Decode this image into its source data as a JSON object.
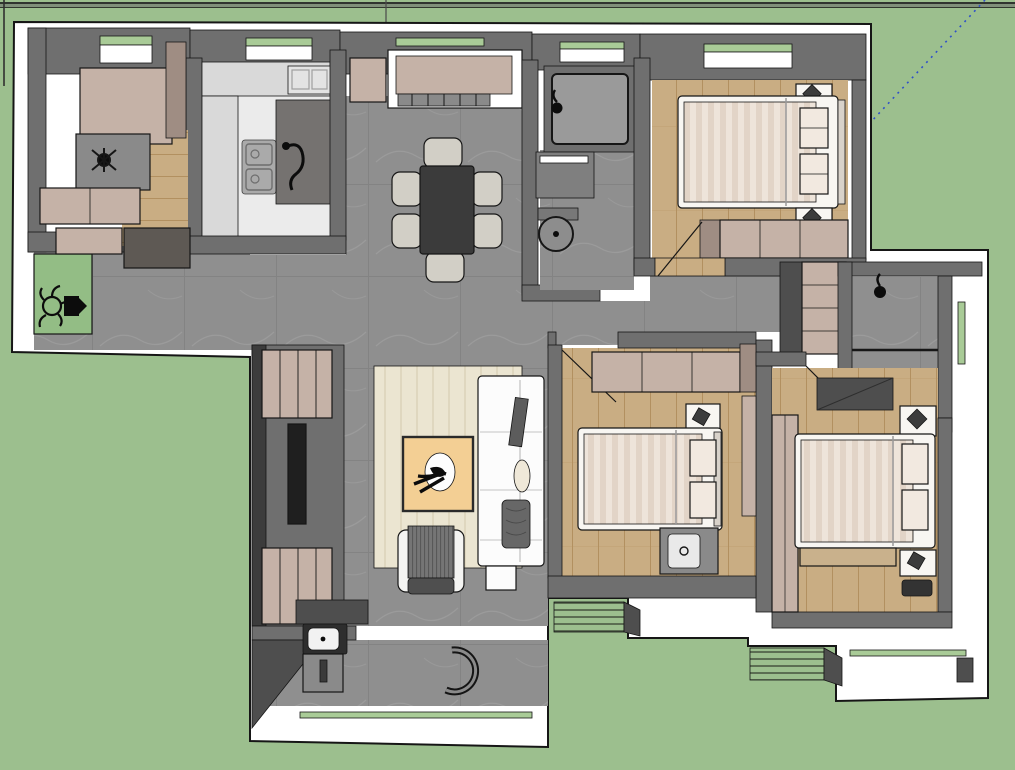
{
  "scene": {
    "type": "3d-floor-plan-top-view",
    "tool": "sketchup-style-viewport",
    "background": "grass-green ground plane",
    "has_axis_guide_line": true
  },
  "palette": {
    "grass": "#9cbf8e",
    "glassGreen": "#a9cb97",
    "matGreen": "#93bd85",
    "white": "#ffffff",
    "outline": "#161616",
    "wallInner": "#6f6f6f",
    "wallInnerDark": "#4e4e4e",
    "wallShadow": "#3c3c3c",
    "tile": "#8f8f8f",
    "tileVein": "#9d9d9d",
    "wood": "#c9ad83",
    "plankLine": "#b29060",
    "beige": "#c5b2a7",
    "beigeDark": "#9f8d83",
    "bedWhite": "#f8f6f2",
    "duvet": "#eee4da",
    "duvetStripe": "#e2d4c7",
    "pillow": "#f2e9e0",
    "counter": "#d9d9d9",
    "kitchenFloor": "#ebebeb",
    "peninsula": "#757270",
    "tableDark": "#3b3b3b",
    "chairSeat": "#d2cfc6",
    "rug": "#ebe5d1",
    "rugStripe": "#dfd7bf",
    "coffeeTable": "#f3cf94",
    "sofa": "#fcfcfc",
    "cushionDark": "#5c5c5c",
    "armchair": "#757575",
    "steel": "#8a8a8a",
    "tvBlack": "#1f1f1f",
    "black": "#0c0c0c",
    "guideBlue": "#3050c8",
    "louverLine": "#3f4a39"
  },
  "inventory": {
    "bedrooms": 3,
    "double_beds": 3,
    "bathrooms": 3,
    "toilets": 3,
    "showers": 3,
    "dining_table": 1,
    "dining_chairs": 6,
    "sofa": 1,
    "armchair": 1,
    "lounge_chair": 1,
    "coffee_table": 1,
    "desk": 1,
    "kitchen": 1,
    "balcony": 1,
    "wardrobes": 5,
    "nightstands": 5,
    "ac_louver_platforms": 2,
    "entry_door_mat": 1
  }
}
